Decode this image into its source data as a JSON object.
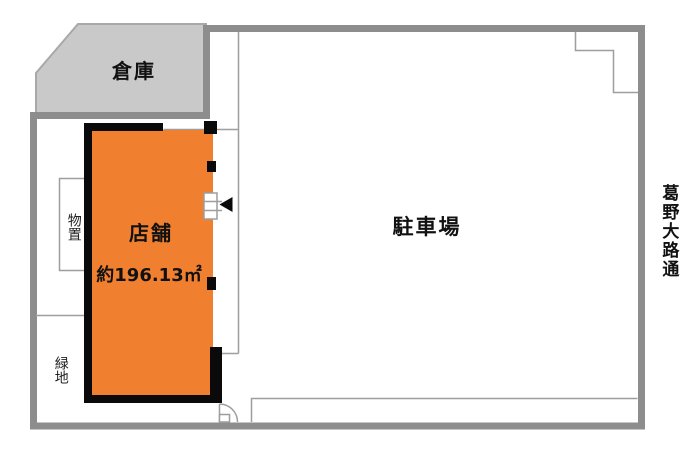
{
  "plan": {
    "warehouse": {
      "label": "倉庫"
    },
    "store": {
      "label": "店舗",
      "area": "約196.13㎡"
    },
    "parking": {
      "label": "駐車場"
    },
    "storage": {
      "label": "物置"
    },
    "green": {
      "label": "緑地"
    },
    "street": {
      "label": "葛野大路通"
    }
  },
  "colors": {
    "store_fill": "#F08030",
    "warehouse_fill": "#C9C9C9",
    "boundary": "#8D8D8D",
    "thin_line": "#9E9E9E",
    "wall": "#0A0A0A",
    "text": "#111111"
  }
}
